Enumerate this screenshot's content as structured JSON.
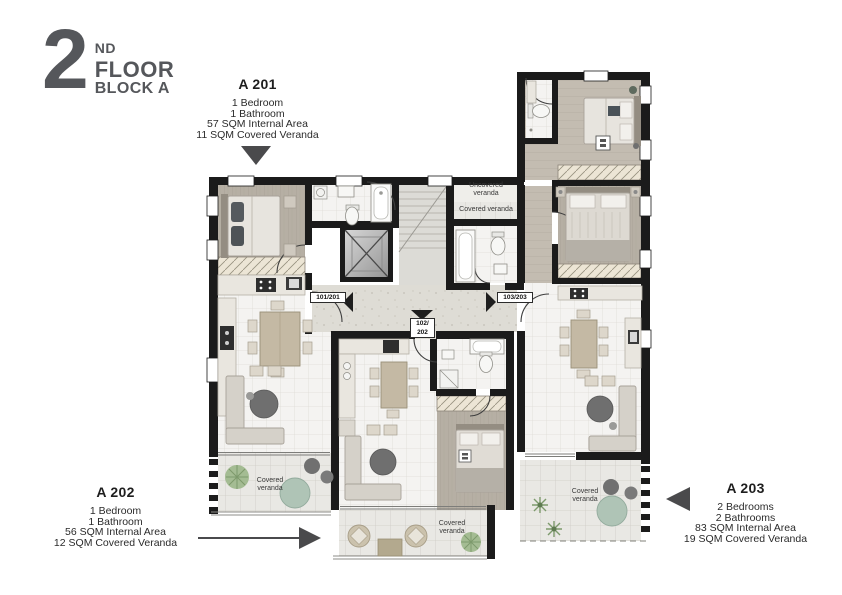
{
  "header": {
    "floor_number": "2",
    "floor_ordinal": "ND",
    "floor_line1": "FLOOR",
    "floor_line2": "BLOCK A"
  },
  "units": [
    {
      "id": "A 201",
      "lines": [
        "1 Bedroom",
        "1 Bathroom",
        "57 SQM Internal Area",
        "11 SQM Covered Veranda"
      ]
    },
    {
      "id": "A 202",
      "lines": [
        "1 Bedroom",
        "1 Bathroom",
        "56 SQM Internal Area",
        "12 SQM Covered Veranda"
      ]
    },
    {
      "id": "A 203",
      "lines": [
        "2 Bedrooms",
        "2 Bathrooms",
        "83 SQM Internal Area",
        "19 SQM Covered Veranda"
      ]
    }
  ],
  "plan": {
    "room_labels": {
      "uncovered_veranda": "Uncovered veranda",
      "covered_veranda": "Covered veranda"
    },
    "door_labels": {
      "a201": "101/201",
      "a202_line1": "102/",
      "a202_line2": "202",
      "a203": "103/203"
    }
  },
  "colors": {
    "title_text": "#55575b",
    "body_text": "#2b2b2b",
    "walls": "#1b1b1b",
    "arrows": "#4a4a4c",
    "plant_green": "#9cb78a",
    "table_sage": "#afc4b6"
  }
}
